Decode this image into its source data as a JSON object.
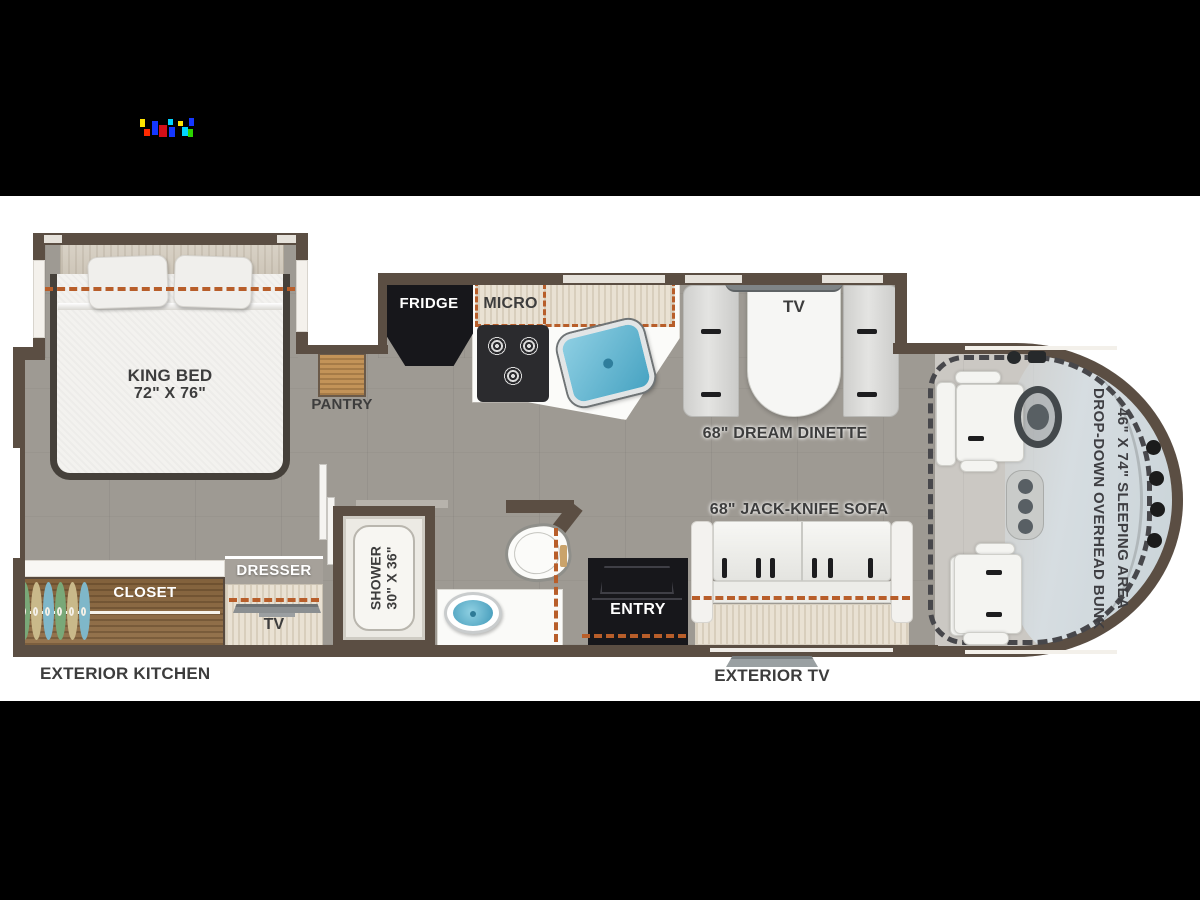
{
  "colors": {
    "background": "#000000",
    "plan_background": "#ffffff",
    "wall": "#5b4e43",
    "floor": "#9e9a93",
    "cab_floor": "#cbc8c3",
    "slide_dash_accent": "#b85e2a",
    "glass_tint": "#d6dde1",
    "appliance_black": "#17171b",
    "sink_blue": "#5fb6d4",
    "label_text": "#3d3d3d"
  },
  "icons": {
    "stove": "three-burner-cooktop-icon",
    "kitchen_sink": "sink-icon",
    "bath_sink": "sink-icon",
    "toilet": "toilet-icon",
    "steering": "steering-wheel-icon",
    "hangers": "clothes-hanger-icons",
    "exterior_tv": "tv-mount-icon",
    "logo": "artifact-logo"
  },
  "labels": {
    "bedroom": {
      "bed_line1": "KING BED",
      "bed_line2": "72\" X 76\"",
      "pantry": "PANTRY",
      "closet": "CLOSET",
      "dresser": "DRESSER",
      "tv": "TV"
    },
    "kitchen": {
      "fridge": "FRIDGE",
      "micro": "MICRO"
    },
    "dinette": {
      "tv": "TV",
      "caption": "68\" DREAM DINETTE"
    },
    "living": {
      "sofa": "68\" JACK-KNIFE SOFA",
      "entry": "ENTRY"
    },
    "bath": {
      "shower_line1": "SHOWER",
      "shower_line2": "30\" X 36\""
    },
    "cab": {
      "bunk_line1": "DROP-DOWN OVERHEAD BUNK",
      "bunk_line2": "46\" X 74\" SLEEPING AREA"
    },
    "exterior": {
      "kitchen": "EXTERIOR KITCHEN",
      "tv": "EXTERIOR TV"
    }
  }
}
